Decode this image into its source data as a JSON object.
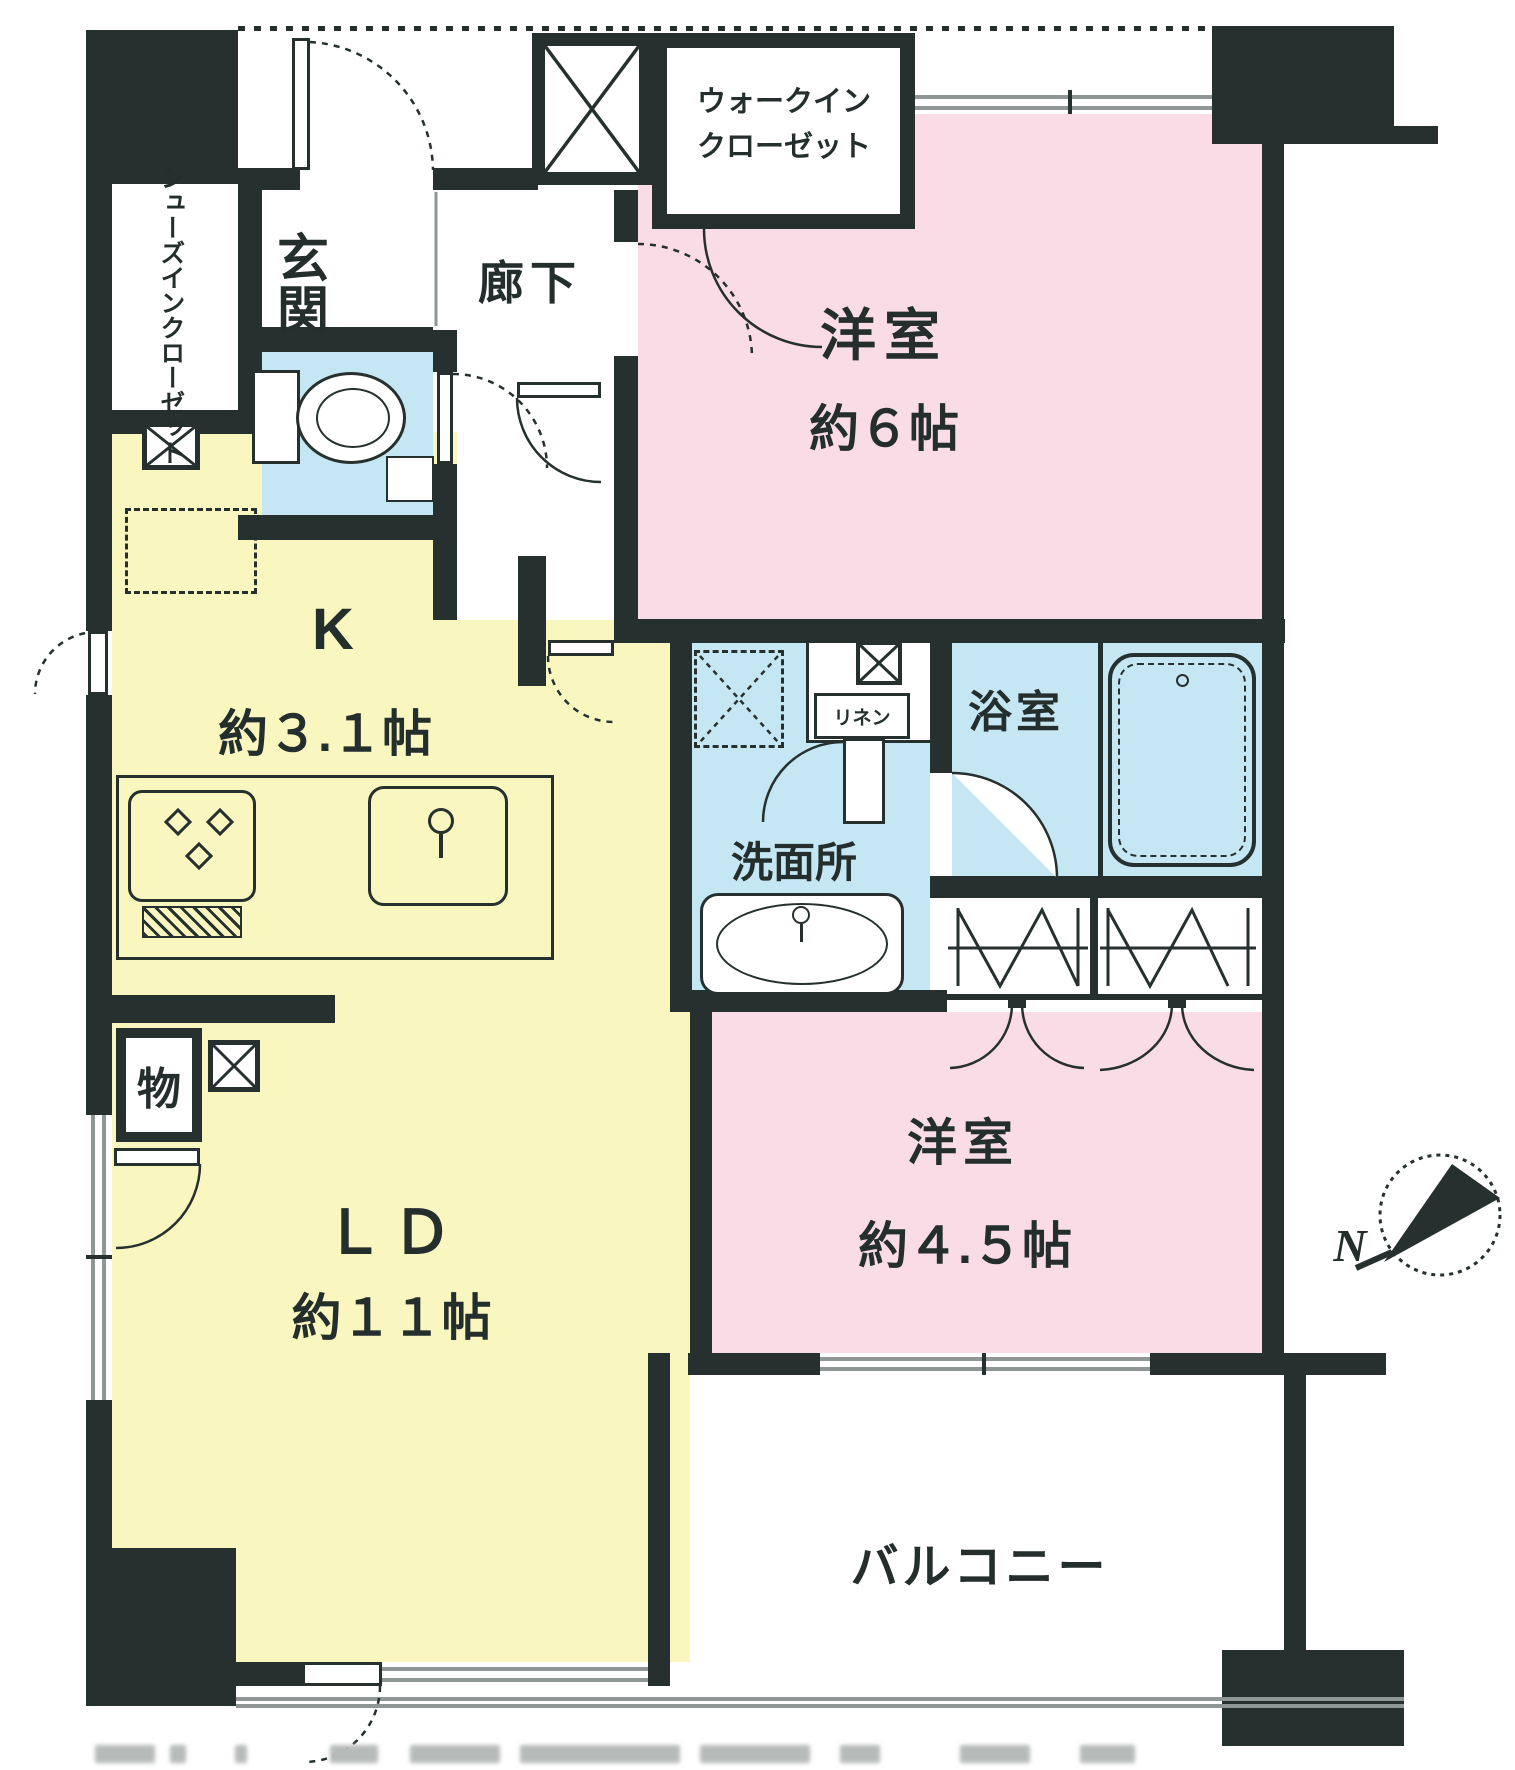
{
  "colors": {
    "wall": "#26302f",
    "living_yellow": "#f9f6c0",
    "bedroom_pink": "#f9dce6",
    "water_blue": "#c4e7f3",
    "window_gray": "#8f9696"
  },
  "rooms": {
    "walk_in_closet": {
      "line1": "ウォークイン",
      "line2": "クローゼット"
    },
    "shoes_closet": {
      "line1": "シューズイン",
      "line2": "クローゼット"
    },
    "entrance": {
      "name": "玄関"
    },
    "hallway": {
      "name": "廊下"
    },
    "western6": {
      "name": "洋室",
      "size": "約６帖"
    },
    "kitchen": {
      "name": "K",
      "size": "約３.１帖"
    },
    "living_dining": {
      "name": "ＬＤ",
      "size": "約１１帖"
    },
    "washroom": {
      "name": "洗面所"
    },
    "bathroom": {
      "name": "浴室"
    },
    "western45": {
      "name": "洋室",
      "size": "約４.５帖"
    },
    "balcony": {
      "name": "バルコニー"
    },
    "storage": {
      "name": "物"
    },
    "linen": {
      "name": "リネン"
    }
  },
  "compass": {
    "north_label": "N"
  }
}
